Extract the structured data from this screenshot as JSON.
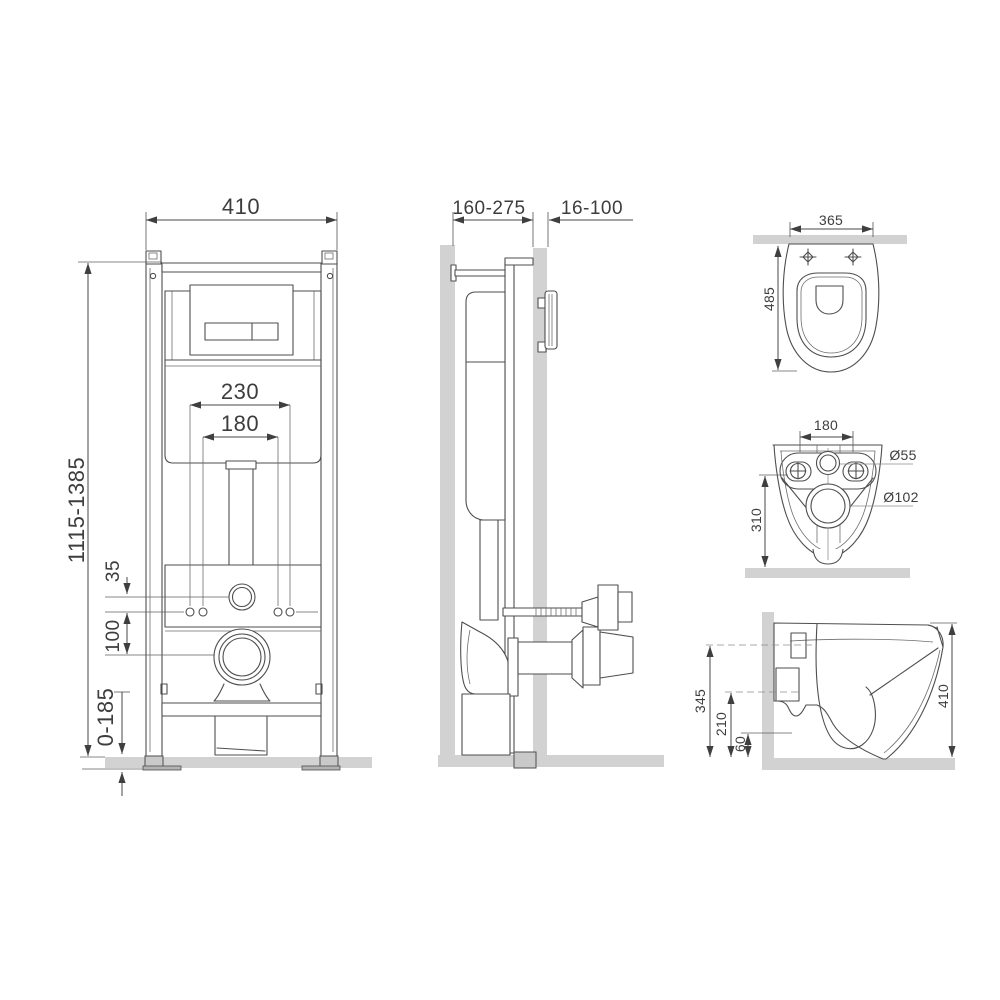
{
  "frame_front_view": {
    "frame_width": "410",
    "frame_height_range": "1115-1385",
    "stud_spacing_wide": "230",
    "stud_spacing_narrow": "180",
    "inlet_to_studs_offset": "35",
    "studs_to_drain_offset": "100",
    "foot_adjustment_range": "0-185"
  },
  "frame_side_view": {
    "installation_depth_range": "160-275",
    "wall_cladding_range": "16-100"
  },
  "bowl_top_view": {
    "bowl_width": "365",
    "bowl_depth": "485"
  },
  "bowl_rear_view": {
    "bolt_spacing": "180",
    "mounting_height": "310",
    "inlet_diameter": "Ø55",
    "outlet_diameter": "Ø102"
  },
  "bowl_side_view": {
    "inlet_axis_height": "345",
    "outlet_axis_height": "210",
    "bottom_clearance": "60",
    "bowl_height": "410"
  },
  "colors": {
    "line": "#4e4e4e",
    "dimension_text": "#3d3d3d",
    "wall_fill": "#d2d2d2",
    "background": "#ffffff"
  }
}
